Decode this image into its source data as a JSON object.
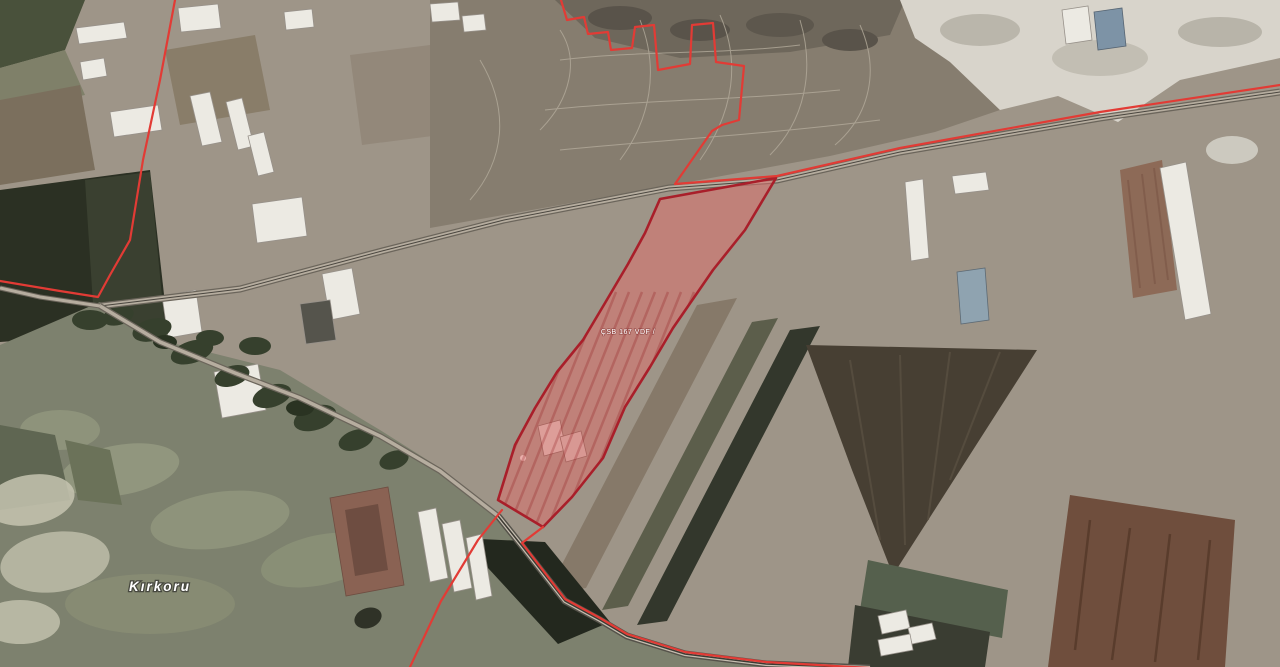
{
  "map": {
    "labels": [
      {
        "id": "place",
        "text": "Kırkoru"
      },
      {
        "id": "parcel",
        "text": "ÇSB 167 VDF /"
      }
    ],
    "colors": {
      "boundary_red": "#e23b35",
      "parcel_border": "#a91f2a",
      "parcel_fill": "rgba(225,110,105,0.5)",
      "parcel_streak": "rgba(148,28,34,0.28)",
      "label_white": "#ffffff"
    },
    "overlay": {
      "boundary_lines": [
        {
          "name": "north-zigzag-highway-boundary",
          "points": [
            [
              561,
              0
            ],
            [
              567,
              20
            ],
            [
              584,
              17
            ],
            [
              588,
              34
            ],
            [
              608,
              32
            ],
            [
              611,
              50
            ],
            [
              632,
              48
            ],
            [
              635,
              27
            ],
            [
              654,
              25
            ],
            [
              658,
              70
            ],
            [
              690,
              64
            ],
            [
              692,
              25
            ],
            [
              713,
              23
            ],
            [
              716,
              62
            ],
            [
              744,
              66
            ],
            [
              739,
              120
            ],
            [
              722,
              125
            ],
            [
              712,
              131
            ],
            [
              675,
              184
            ],
            [
              777,
              176
            ],
            [
              900,
              148
            ],
            [
              1100,
              112
            ],
            [
              1280,
              85
            ]
          ]
        },
        {
          "name": "west-boundary",
          "points": [
            [
              175,
              0
            ],
            [
              160,
              80
            ],
            [
              143,
              160
            ],
            [
              130,
              240
            ],
            [
              110,
              275
            ],
            [
              98,
              297
            ],
            [
              60,
              291
            ],
            [
              0,
              281
            ]
          ]
        },
        {
          "name": "southeast-road-boundary",
          "points": [
            [
              543,
              527
            ],
            [
              522,
              543
            ],
            [
              565,
              599
            ],
            [
              600,
              618
            ],
            [
              627,
              634
            ],
            [
              685,
              652
            ],
            [
              766,
              662
            ],
            [
              870,
              668
            ]
          ]
        },
        {
          "name": "south-boundary",
          "points": [
            [
              502,
              510
            ],
            [
              478,
              540
            ],
            [
              441,
              601
            ],
            [
              410,
              667
            ]
          ]
        }
      ],
      "parcel": {
        "outline": [
          [
            660,
            199
          ],
          [
            776,
            178
          ],
          [
            745,
            230
          ],
          [
            713,
            270
          ],
          [
            673,
            328
          ],
          [
            650,
            367
          ],
          [
            625,
            407
          ],
          [
            603,
            458
          ],
          [
            572,
            497
          ],
          [
            543,
            527
          ],
          [
            498,
            500
          ],
          [
            515,
            445
          ],
          [
            535,
            408
          ],
          [
            557,
            372
          ],
          [
            583,
            340
          ],
          [
            605,
            303
          ],
          [
            628,
            264
          ],
          [
            645,
            233
          ]
        ]
      }
    }
  }
}
